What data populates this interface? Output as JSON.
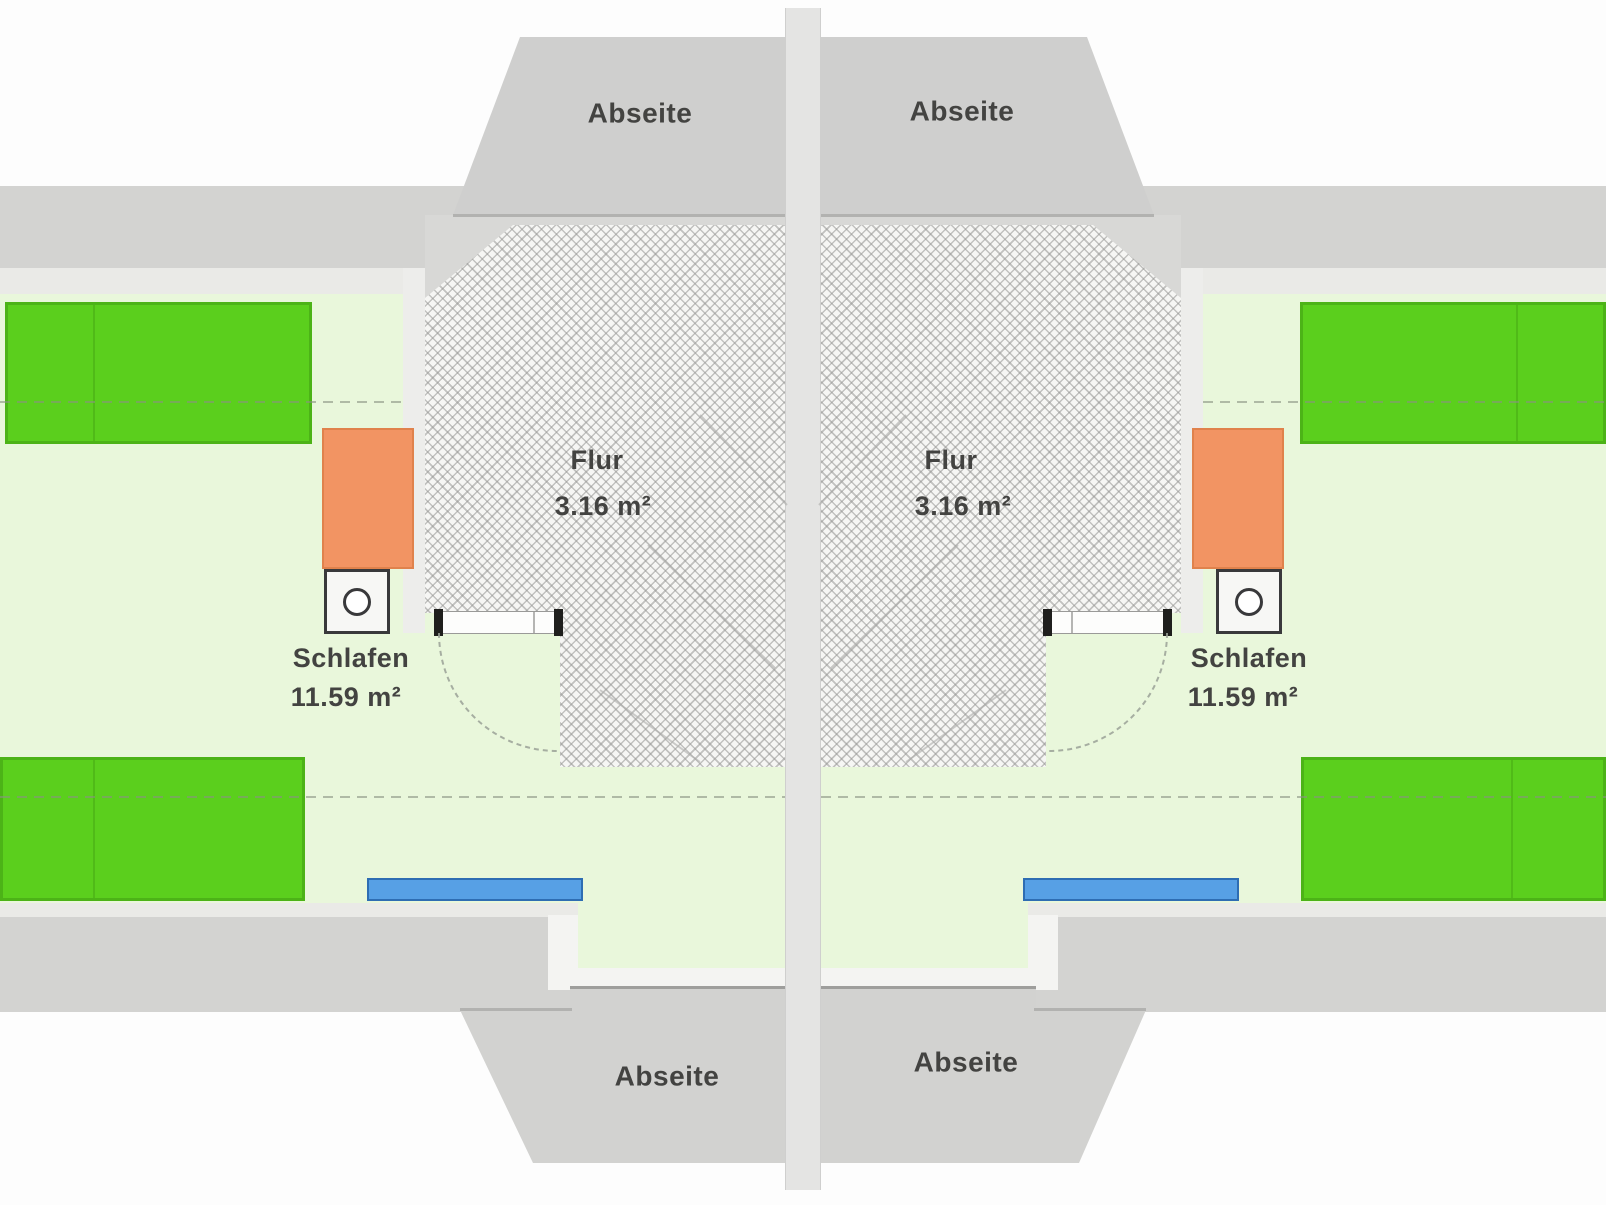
{
  "floorplan": {
    "type": "attic-floor-plan-duplex",
    "areas": {
      "abseite_top_left": {
        "label": "Abseite"
      },
      "abseite_top_right": {
        "label": "Abseite"
      },
      "abseite_bottom_left": {
        "label": "Abseite"
      },
      "abseite_bottom_right": {
        "label": "Abseite"
      },
      "flur_left": {
        "label": "Flur",
        "area": "3.16 m²"
      },
      "flur_right": {
        "label": "Flur",
        "area": "3.16 m²"
      },
      "schlafen_left": {
        "label": "Schlafen",
        "area": "11.59 m²"
      },
      "schlafen_right": {
        "label": "Schlafen",
        "area": "11.59 m²"
      }
    },
    "colors": {
      "wall": "#d3d3d1",
      "wall_light": "#eaeae7",
      "dormer": "#cfcfce",
      "divider": "#e4e4e3",
      "room": "#e9f7db",
      "bed": "#5bcf1d",
      "bed_border": "#4cb317",
      "wardrobe": "#f29463",
      "window": "#57a0e5",
      "window_border": "#2e6db3",
      "hatch_bg": "#f6f6f4",
      "label": "#434341"
    }
  }
}
